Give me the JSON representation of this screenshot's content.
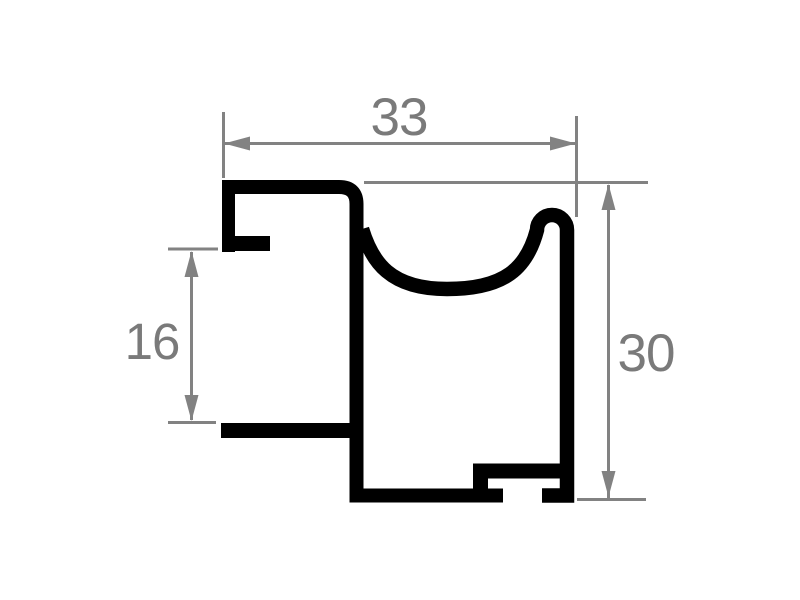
{
  "drawing": {
    "dimension_labels": {
      "width": "33",
      "rabbet": "16",
      "height": "30"
    },
    "colors": {
      "profile_line": "#000000",
      "dimension_line": "#828282",
      "dimension_text": "#7a7a7a",
      "background": "#ffffff"
    }
  }
}
